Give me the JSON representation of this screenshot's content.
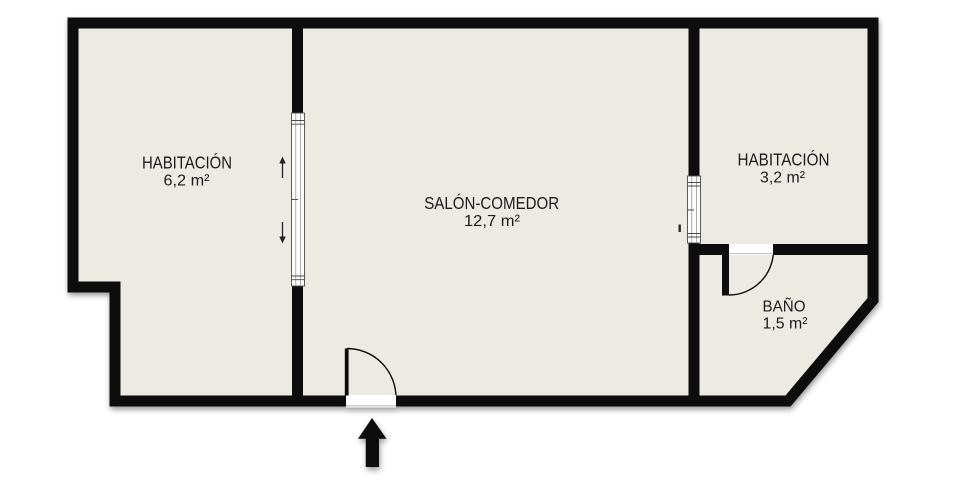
{
  "plan": {
    "background_color": "#ffffff",
    "wall_color": "#0c0c0c",
    "floor_color": "#edeae4",
    "text_color": "#1a1a1a",
    "track_color": "#4a4a4a",
    "threshold_color": "#bdbdbd",
    "rooms": [
      {
        "name": "HABITACIÓN",
        "area": "6,2 m²"
      },
      {
        "name": "SALÓN-COMEDOR",
        "area": "12,7 m²"
      },
      {
        "name": "HABITACIÓN",
        "area": "3,2 m²"
      },
      {
        "name": "BAÑO",
        "area": "1,5 m²"
      }
    ],
    "icons": {
      "entrance_arrow": "arrow-up",
      "sliding_door_left_arrows": [
        "arrow-up",
        "arrow-down"
      ]
    }
  }
}
